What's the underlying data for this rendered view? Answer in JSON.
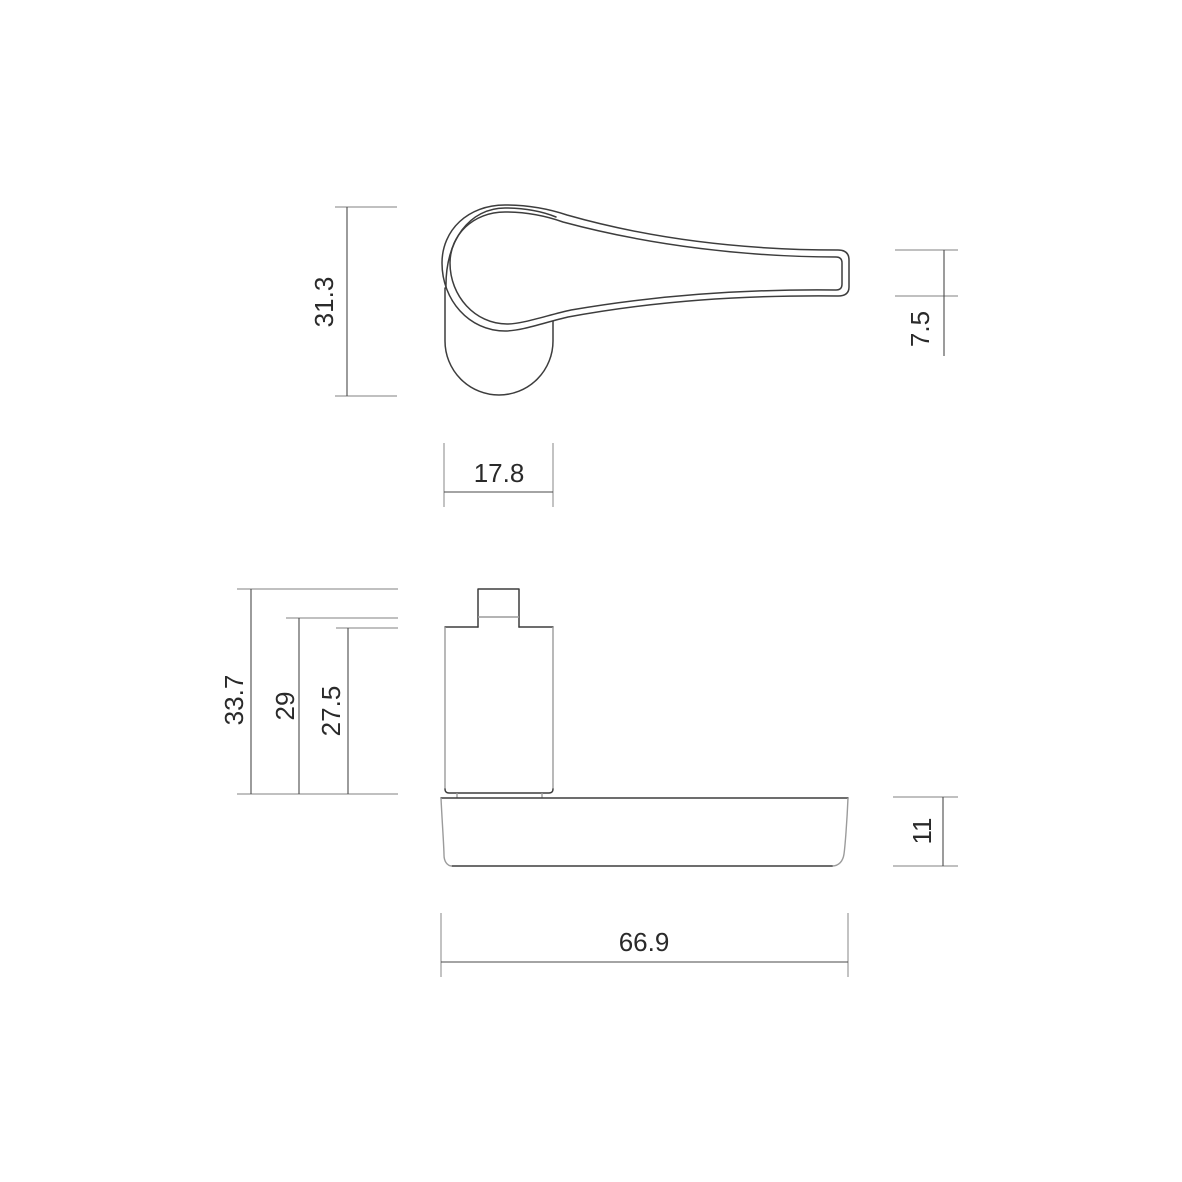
{
  "theme": {
    "background": "#ffffff",
    "outline_color": "#3d3d3d",
    "secondary_color": "#9b9b9b",
    "dim_line_color": "#4a4a4a",
    "text_color": "#2a2a2a"
  },
  "dimensions": {
    "plan_overall_depth": "31.3",
    "lever_end_thickness": "7.5",
    "rose_width": "17.8",
    "overall_height": "33.7",
    "rose_spindle_height": "29",
    "rose_body_height": "27.5",
    "lever_profile_height": "11",
    "overall_length": "66.9"
  }
}
